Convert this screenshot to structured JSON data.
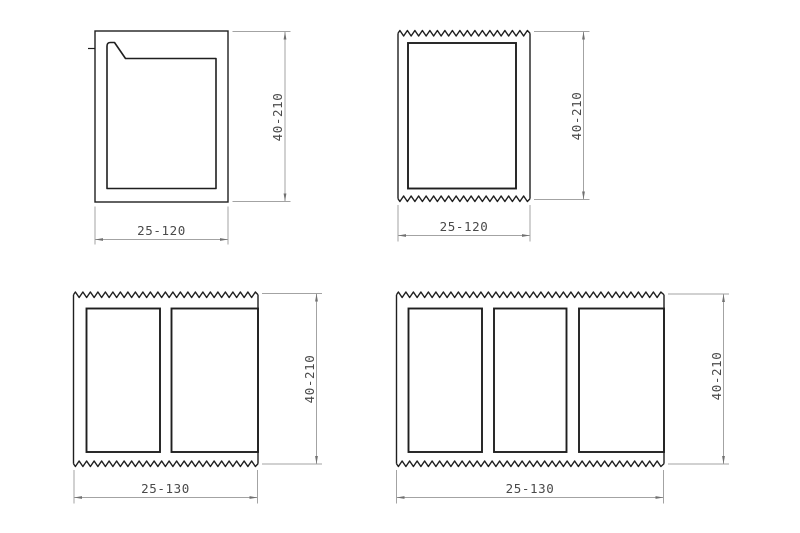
{
  "drawing": {
    "background": "#ffffff",
    "colors": {
      "object_line": "#1f1f1f",
      "dimension_line": "#a3a3a3",
      "arrow": "#707070",
      "label_text": "#4a4a4a"
    },
    "figures": [
      {
        "height_label": "40-210",
        "width_label": "25-120"
      },
      {
        "height_label": "40-210",
        "width_label": "25-120"
      },
      {
        "height_label": "40-210",
        "width_label": "25-130"
      },
      {
        "height_label": "40-210",
        "width_label": "25-130"
      }
    ]
  }
}
